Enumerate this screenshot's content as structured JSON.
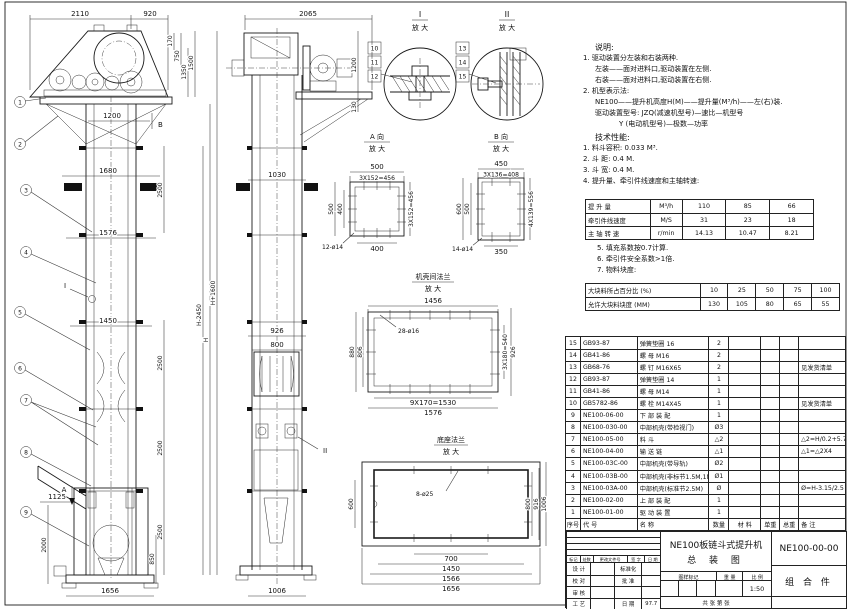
{
  "front_view": {
    "balloons": [
      "1",
      "2",
      "3",
      "4",
      "5",
      "6",
      "7",
      "8",
      "9"
    ],
    "detail_flag": "I",
    "section_a": "A",
    "section_b": "B",
    "dims": {
      "total_width": "2110",
      "head_right": "920",
      "d170": "170",
      "d750": "750",
      "d1350": "1350",
      "d1500": "1500",
      "d1200": "1200",
      "d1680": "1680",
      "d1576": "1576",
      "d1450": "1450",
      "sec": "2500",
      "h_plus": "H+1600",
      "h_minus": "H-2450",
      "h": "H",
      "d1125": "1125",
      "d2000": "2000",
      "d850": "850",
      "d1656": "1656"
    }
  },
  "side_view": {
    "marker": "II",
    "dims": {
      "d2065": "2065",
      "d1200": "1200",
      "d130": "130",
      "d1030": "1030",
      "d926": "926",
      "d800": "800",
      "d1006": "1006"
    }
  },
  "detail_i": {
    "title": "I",
    "sub": "放 大",
    "balloons": [
      "10",
      "11",
      "12"
    ]
  },
  "detail_ii": {
    "title": "II",
    "sub": "放 大",
    "balloons": [
      "13",
      "14",
      "15"
    ]
  },
  "view_a": {
    "title": "A 向",
    "sub": "放 大",
    "dims": {
      "top": "500",
      "pitch_top": "3X152=456",
      "left": "500",
      "left_inner": "400",
      "pitch_right": "3X152=456",
      "bottom": "400",
      "holes": "12-ø14"
    }
  },
  "view_b": {
    "title": "B 向",
    "sub": "放 大",
    "dims": {
      "top": "450",
      "pitch_top": "3X136=408",
      "left": "600",
      "left_inner": "500",
      "pitch_right": "4X139=556",
      "bottom": "350",
      "holes": "14-ø14"
    }
  },
  "flange_view": {
    "title": "机壳间法兰",
    "sub": "放 大",
    "dims": {
      "top": "1456",
      "holes": "28-ø16",
      "left": "880",
      "left_inner": "806",
      "pitch_right": "3X180=540",
      "right": "926",
      "pitch_bottom": "9X170=1530",
      "bottom": "1576"
    }
  },
  "base_view": {
    "title": "底座法兰",
    "sub": "放 大",
    "dims": {
      "holes": "8-ø25",
      "left": "600",
      "right1": "800",
      "right2": "916",
      "right3": "1006",
      "b700": "700",
      "b1450": "1450",
      "b1566": "1566",
      "b1656": "1656"
    }
  },
  "notes": {
    "lines": [
      {
        "t": "说明:",
        "ind": 1,
        "head": true
      },
      {
        "t": "1. 驱动装置分左装和右装两种.",
        "ind": 0
      },
      {
        "t": "左装——面对进料口,驱动装置在左侧.",
        "ind": 1
      },
      {
        "t": "右装——面对进料口,驱动装置在右侧.",
        "ind": 1
      },
      {
        "t": "2. 机型表示法:",
        "ind": 0
      },
      {
        "t": "NE100——提升机高度H(M)——提升量(M³/h)——左(右)装.",
        "ind": 1
      },
      {
        "t": "驱动装置型号: JZQ(减速机型号)—速比—机型号",
        "ind": 1
      },
      {
        "t": "Y (电动机型号)—极数—功率",
        "ind": 3
      },
      {
        "t": "技术性能:",
        "ind": 1,
        "head": true
      },
      {
        "t": "1. 料斗容积: 0.033 M³.",
        "ind": 0
      },
      {
        "t": "2. 斗  距: 0.4 M.",
        "ind": 0
      },
      {
        "t": "3. 斗  宽: 0.4 M.",
        "ind": 0
      },
      {
        "t": "4. 提升量、牵引件线速度和主轴转速:",
        "ind": 0
      }
    ]
  },
  "speed_table": {
    "rows": [
      [
        "提 升 量",
        "M³/h",
        "110",
        "85",
        "66"
      ],
      [
        "牵引件线速度",
        "M/S",
        "31",
        "23",
        "18"
      ],
      [
        "主 轴 转 速",
        "r/min",
        "14.13",
        "10.47",
        "8.21"
      ]
    ]
  },
  "post_notes": {
    "lines": [
      {
        "t": "5. 填充系数按0.7计算.",
        "ind": 0
      },
      {
        "t": "6. 牵引件安全系数>1倍.",
        "ind": 0
      },
      {
        "t": "7. 物料块度:",
        "ind": 0
      }
    ]
  },
  "size_table": {
    "rows": [
      [
        "大块料所占百分比 (%)",
        "10",
        "25",
        "50",
        "75",
        "100"
      ],
      [
        "允许大块料块度 (MM)",
        "130",
        "105",
        "80",
        "65",
        "55"
      ]
    ]
  },
  "bom": {
    "rows": [
      [
        "15",
        "GB93-87",
        "弹簧垫圈  16",
        "2",
        "",
        "",
        "",
        ""
      ],
      [
        "14",
        "GB41-86",
        "螺 母  M16",
        "2",
        "",
        "",
        "",
        ""
      ],
      [
        "13",
        "GB68-76",
        "螺 钉  M16X65",
        "2",
        "",
        "",
        "",
        "见发货清单"
      ],
      [
        "12",
        "GB93-87",
        "弹簧垫圈  14",
        "1",
        "",
        "",
        "",
        ""
      ],
      [
        "11",
        "GB41-86",
        "螺 母  M14",
        "1",
        "",
        "",
        "",
        ""
      ],
      [
        "10",
        "GB5782-86",
        "螺 栓  M14X45",
        "1",
        "",
        "",
        "",
        "见发货清单"
      ],
      [
        "9",
        "NE100-06-00",
        "下 部 装 配",
        "1",
        "",
        "",
        "",
        ""
      ],
      [
        "8",
        "NE100-030-00",
        "中部机壳(带检视门)",
        "Ø3",
        "",
        "",
        "",
        ""
      ],
      [
        "7",
        "NE100-05-00",
        "料 斗",
        "△2",
        "",
        "",
        "",
        "△2=H/0.2+5.75"
      ],
      [
        "6",
        "NE100-04-00",
        "输 送 链",
        "△1",
        "",
        "",
        "",
        "△1=△2X4"
      ],
      [
        "5",
        "NE100-03C-00",
        "中部机壳(带导轨)",
        "Ø2",
        "",
        "",
        "",
        ""
      ],
      [
        "4",
        "NE100-03B-00",
        "中部机壳(非标节1.5M,1M)",
        "Ø1",
        "",
        "",
        "",
        ""
      ],
      [
        "3",
        "NE100-03A-00",
        "中部机壳(标准节2.5M)",
        "Ø",
        "",
        "",
        "",
        "Ø=H-3.15/2.5"
      ],
      [
        "2",
        "NE100-02-00",
        "上 部 装 配",
        "1",
        "",
        "",
        "",
        ""
      ],
      [
        "1",
        "NE100-01-00",
        "驱 动 装 置",
        "1",
        "",
        "",
        "",
        ""
      ],
      [
        "序号",
        "代  号",
        "名    称",
        "数量",
        "材  料",
        "单重",
        "总重",
        "备  注"
      ]
    ]
  },
  "title_block": {
    "rev_header_rows": [
      [
        "标记",
        "处数",
        "更改文件号",
        "签 字",
        "日 期"
      ]
    ],
    "sig_rows": [
      [
        "设 计",
        "",
        "标准化",
        ""
      ],
      [
        "校 对",
        "",
        "批 准",
        ""
      ],
      [
        "审 核",
        "",
        "",
        ""
      ],
      [
        "工 艺",
        "",
        "日 期",
        "97.7"
      ]
    ],
    "title_line1": "NE100板链斗式提升机",
    "title_line2": "总  装  图",
    "mark_header_rows": [
      [
        "图样标记",
        "重  量",
        "比  例"
      ]
    ],
    "scale": "1:50",
    "sheet_label": "共  张  第  张",
    "drawing_no": "NE100-00-00",
    "part_kind": "组 合 件"
  }
}
